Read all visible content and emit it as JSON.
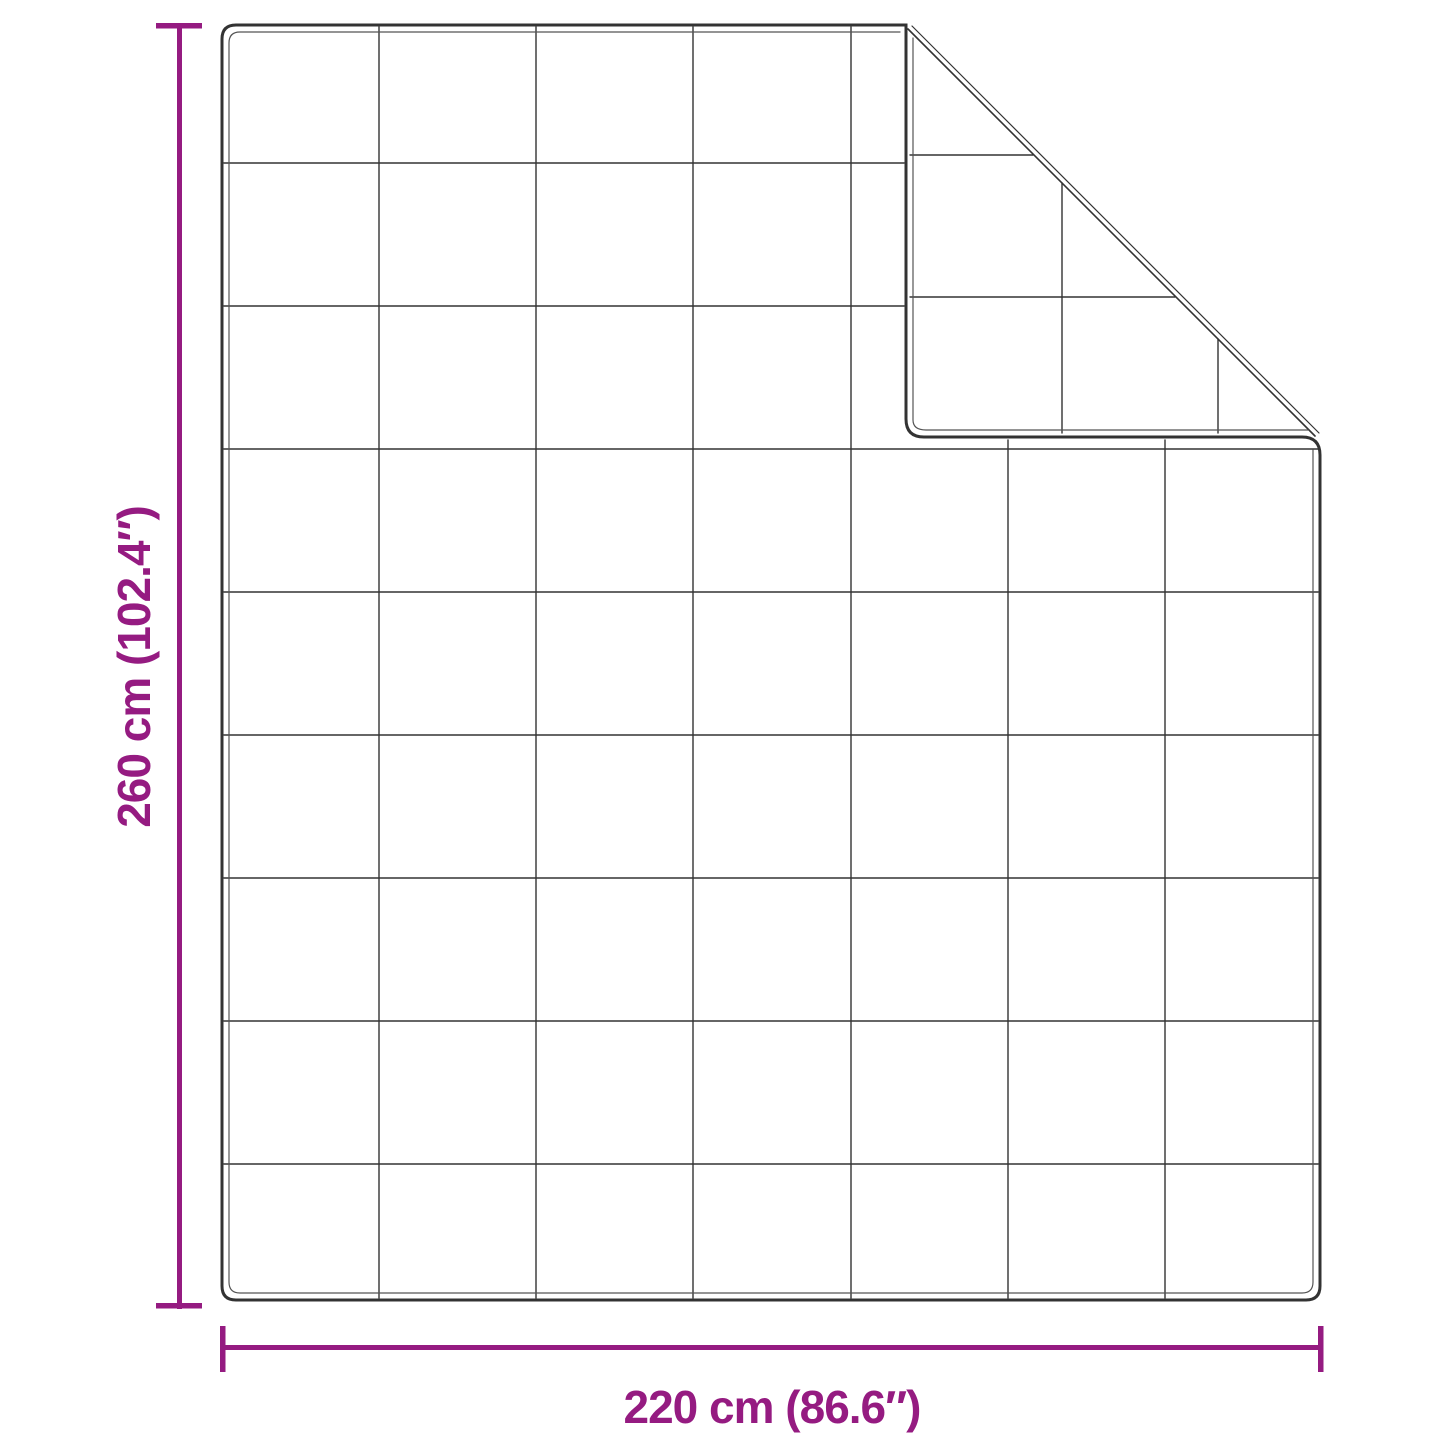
{
  "diagram": {
    "subject": "quilted blanket with folded corner",
    "height_label": "260 cm (102.4″)",
    "width_label": "220 cm (86.6″)"
  },
  "grid": {
    "columns": 7,
    "rows": 9
  },
  "colors": {
    "accent": "#951b81",
    "line": "#333333",
    "stitch": "#555555",
    "background": "#ffffff"
  }
}
